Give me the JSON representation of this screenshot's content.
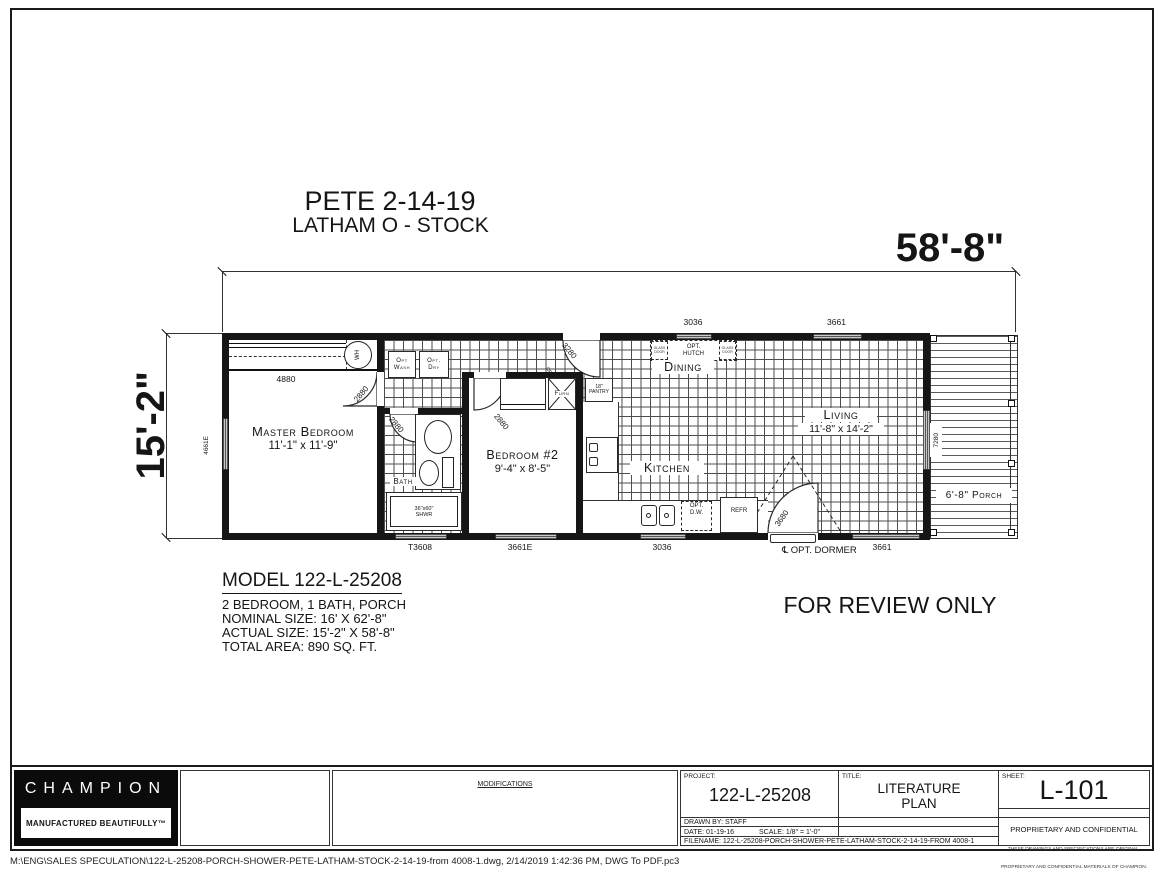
{
  "header": {
    "line1": "PETE 2-14-19",
    "line2": "LATHAM O - STOCK"
  },
  "dims": {
    "width": "58'-8\"",
    "height": "15'-2\"",
    "closet": "4880",
    "left_window": "4661E",
    "patio_door": "7280",
    "top_windows": [
      "3036",
      "3661"
    ],
    "bottom_windows": [
      "T3608",
      "3661E",
      "3036",
      "3661"
    ],
    "doors": {
      "front": "3280",
      "front_opt": "Opt.",
      "master": "2880",
      "bath": "2880",
      "bedroom2": "2880",
      "rear": "3680"
    }
  },
  "rooms": {
    "master": {
      "name": "Master Bedroom",
      "size": "11'-1\" x 11'-9\""
    },
    "bedroom2": {
      "name": "Bedroom #2",
      "size": "9'-4\" x 8'-5\""
    },
    "living": {
      "name": "Living",
      "size": "11'-8\" x 14'-2\""
    },
    "kitchen": "Kitchen",
    "dining": "Dining",
    "bath": "Bath",
    "porch": "6'-8\" Porch"
  },
  "fixtures": {
    "wh": "WH",
    "wash_l1": "Opt",
    "wash_l2": "Wash",
    "dry_l1": "Opt.",
    "dry_l2": "Dry",
    "furn": "Furn",
    "pantry_l1": "18\"",
    "pantry_l2": "PANTRY",
    "shower_l1": "36\"x60\"",
    "shower_l2": "SHWR",
    "hutch_l1": "OPT.",
    "hutch_l2": "HUTCH",
    "glass_door": "GLASS DOOR",
    "dw_l1": "OPT.",
    "dw_l2": "D.W.",
    "refr": "REFR",
    "opt_dormer": "℄ OPT. DORMER"
  },
  "notes": {
    "review": "FOR REVIEW ONLY"
  },
  "model_info": {
    "title": "MODEL 122-L-25208",
    "lines": [
      "2 BEDROOM, 1 BATH, PORCH",
      "NOMINAL SIZE: 16' X 62'-8\"",
      "ACTUAL SIZE: 15'-2\" X 58'-8\"",
      "TOTAL AREA: 890 SQ. FT."
    ]
  },
  "titleblock": {
    "brand": "CHAMPION",
    "tagline": "MANUFACTURED BEAUTIFULLY™",
    "modifications": "MODIFICATIONS",
    "project_label": "PROJECT:",
    "project": "122-L-25208",
    "title_label": "TITLE:",
    "title_l1": "LITERATURE",
    "title_l2": "PLAN",
    "sheet_label": "SHEET:",
    "sheet": "L-101",
    "drawn_by": "DRAWN BY:   STAFF",
    "date": "DATE: 01-19-16",
    "scale": "SCALE:   1/8\" = 1'-0\"",
    "filename": "FILENAME:   122-L-25208-PORCH-SHOWER-PETE-LATHAM-STOCK-2-14-19-FROM 4008-1",
    "proprietary": "PROPRIETARY AND CONFIDENTIAL",
    "legal_l1": "THESE DRAWINGS AND SPECIFICATIONS ARE ORIGINAL,",
    "legal_l2": "PROPRIETARY AND CONFIDENTIAL MATERIALS OF CHAMPION.",
    "copyright": "COPYRIGHT © 1976-2016 BY CHAMPION"
  },
  "footer": {
    "path": "M:\\ENG\\SALES SPECULATION\\122-L-25208-PORCH-SHOWER-PETE-LATHAM-STOCK-2-14-19-from 4008-1.dwg, 2/14/2019 1:42:36 PM, DWG To PDF.pc3"
  }
}
